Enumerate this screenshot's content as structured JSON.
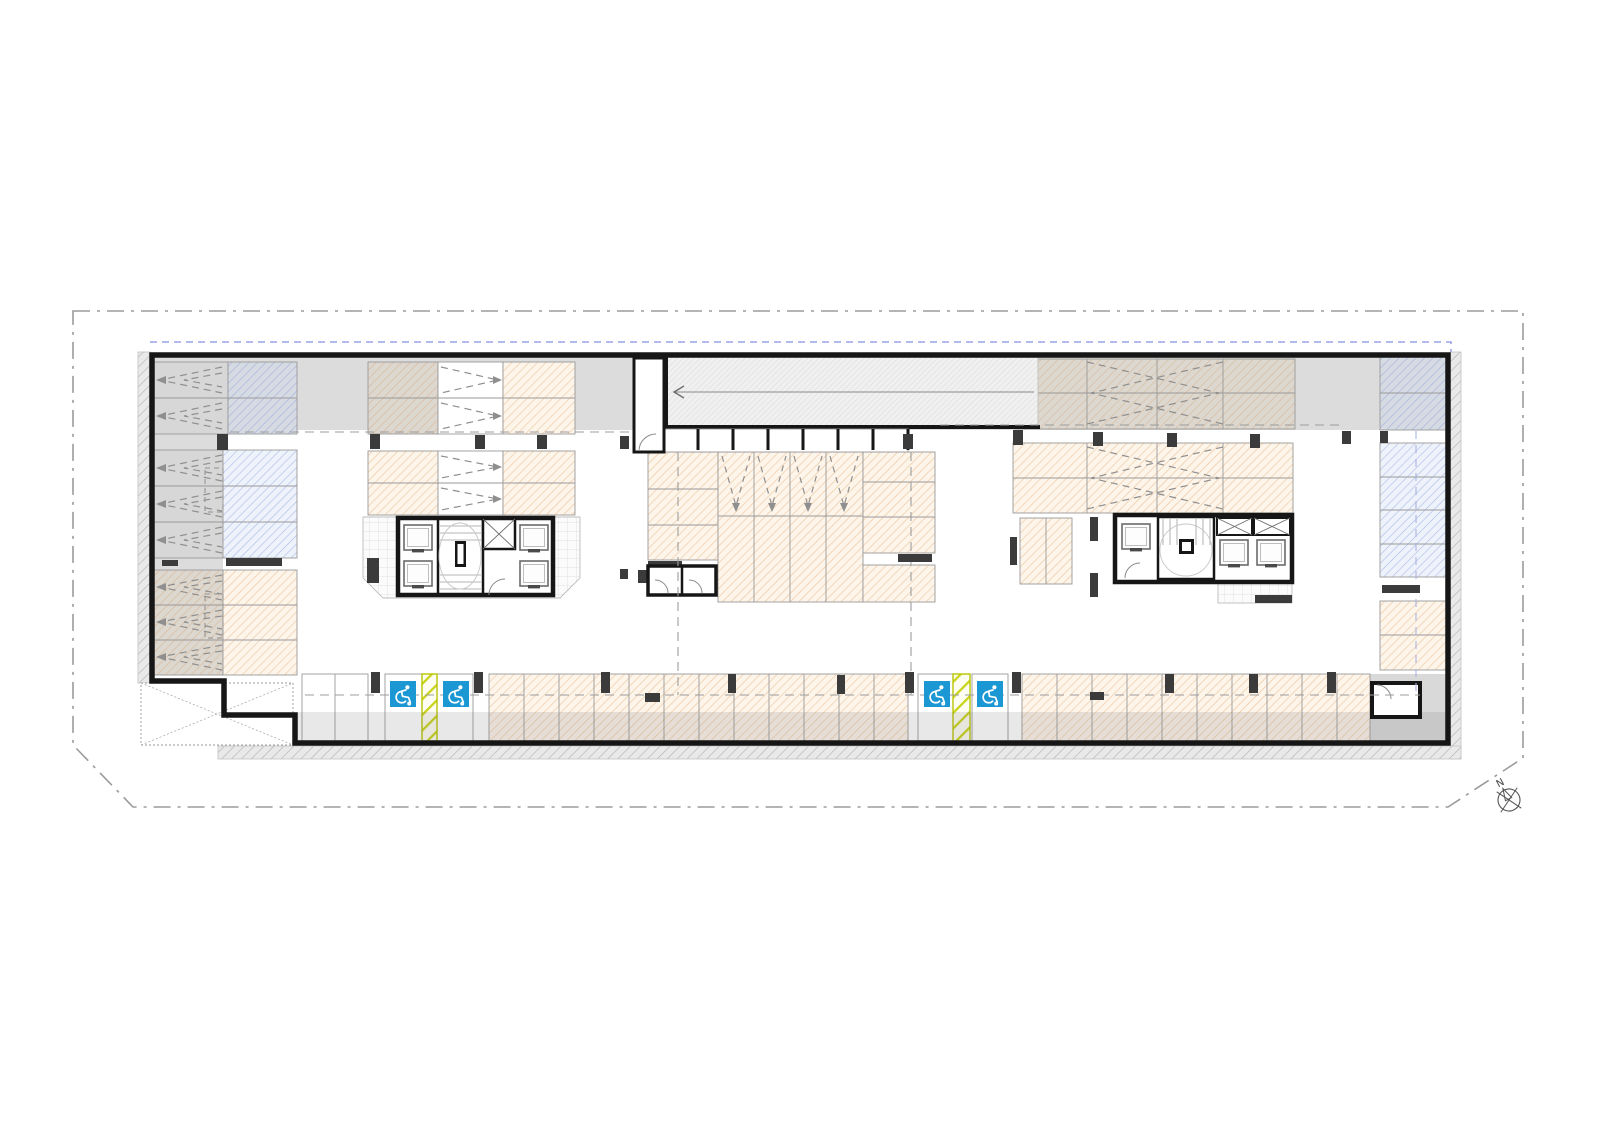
{
  "title": "Underground parking level floor plan",
  "compass": {
    "label": "N"
  },
  "colors": {
    "background": "#ffffff",
    "accessible_blue": "#1b97d4",
    "hazard_yellow_green": "#c3ce17",
    "parking_hatch_orange": "#ecc9a2",
    "parking_hatch_blue": "#aebde8",
    "drive_aisle_gray": "#dcdcdc",
    "wall_black": "#161616",
    "boundary_gray": "#9b9b9b",
    "setback_blue_dashed": "#9aa3e6"
  },
  "features": {
    "accessible_spaces": 4,
    "stair_elevator_cores": 2,
    "ramps": 1,
    "wc_rooms": 2
  },
  "icons": {
    "accessible_parking": "wheelchair-icon",
    "north": "compass-icon"
  }
}
